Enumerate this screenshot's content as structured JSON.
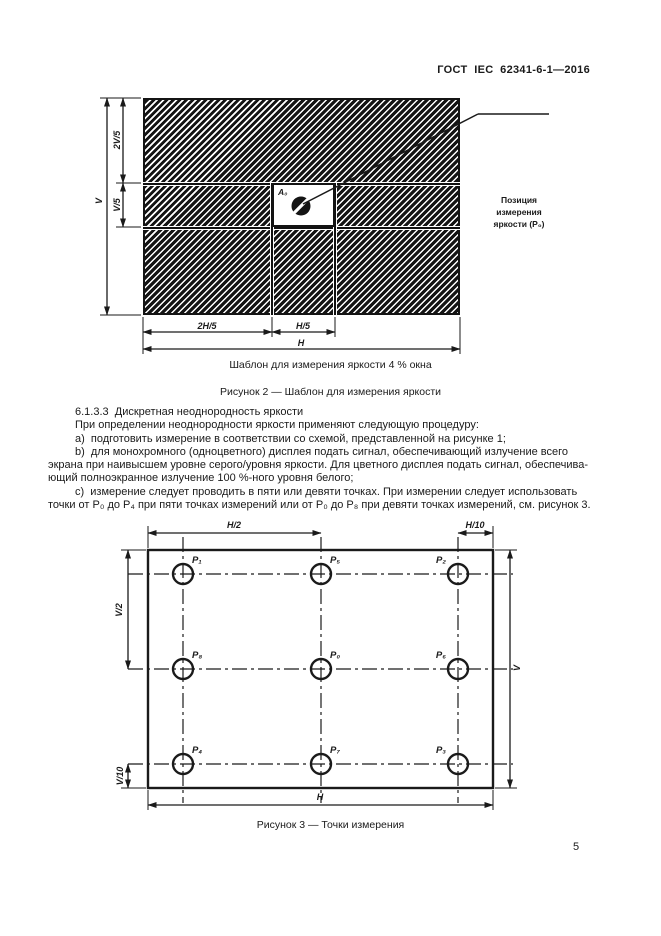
{
  "page": {
    "header": "ГОСТ  IEC  62341-6-1—2016",
    "number": "5",
    "ink_color": "#1a1a1a",
    "background_color": "#ffffff"
  },
  "figure2": {
    "window_label": "A₀",
    "callout": {
      "line1": "Позиция",
      "line2": "измерения",
      "line3": "яркости (P₀)"
    },
    "dims": {
      "v": "V",
      "v2_5": "2V/5",
      "v1_5": "V/5",
      "h2_5": "2H/5",
      "h1_5": "H/5",
      "h": "H"
    },
    "subcaption": "Шаблон для измерения яркости 4 % окна",
    "caption": "Рисунок 2 — Шаблон для измерения яркости"
  },
  "body": {
    "lines": [
      {
        "indent": true,
        "text": "6.1.3.3  Дискретная неоднородность яркости"
      },
      {
        "indent": true,
        "text": "При определении неоднородности яркости применяют следующую процедуру:"
      },
      {
        "indent": true,
        "text": "a)  подготовить измерение в соответствии со схемой, представленной на рисунке 1;"
      },
      {
        "indent": true,
        "text": "b)  для монохромного (одноцветного) дисплея подать сигнал, обеспечивающий излучение всего"
      },
      {
        "indent": false,
        "text": "экрана при наивысшем уровне серого/уровня яркости. Для цветного дисплея подать сигнал, обеспечива-"
      },
      {
        "indent": false,
        "text": "ющий полноэкранное излучение 100 %-ного уровня белого;"
      },
      {
        "indent": true,
        "text": "c)  измерение следует проводить в пяти или девяти точках. При измерении следует использовать"
      },
      {
        "indent": false,
        "text": "точки от P₀ до P₄ при пяти точках измерений или от P₀ до P₈ при девяти точках измерений, см. рисунок 3."
      }
    ]
  },
  "figure3": {
    "points": {
      "p1": "P₁",
      "p5": "P₅",
      "p2": "P₂",
      "p8": "P₈",
      "p0": "P₀",
      "p6": "P₆",
      "p4": "P₄",
      "p7": "P₇",
      "p3": "P₃"
    },
    "dims": {
      "h2": "H/2",
      "h10": "H/10",
      "v2": "V/2",
      "v10": "V/10",
      "v": "V",
      "h": "H"
    },
    "caption": "Рисунок 3 — Точки измерения"
  }
}
